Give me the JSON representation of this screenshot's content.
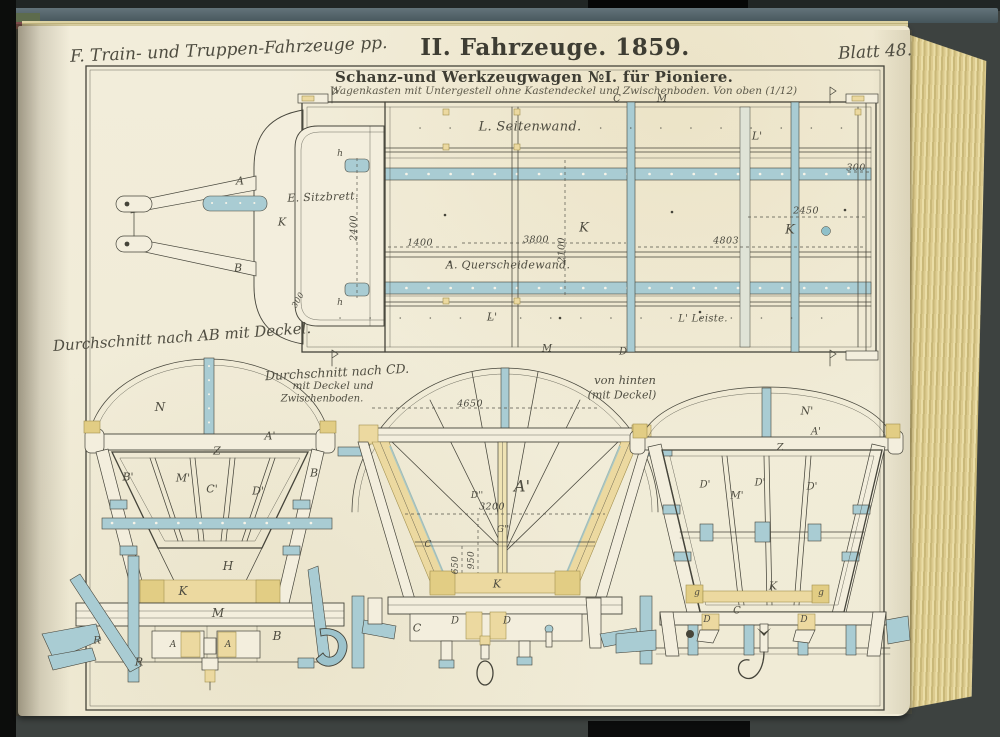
{
  "book": {
    "header_left": "F. Train- und Truppen-Fahrzeuge pp.",
    "header_center": "II. Fahrzeuge. 1859.",
    "header_right": "Blatt 48."
  },
  "plate": {
    "title": "Schanz-und Werkzeugwagen №I. für Pioniere.",
    "subtitle": "Wagenkasten mit Untergestell ohne Kastendeckel und Zwischenboden. Von oben (1/12)",
    "section_ab_caption": "Durchschnitt nach AB mit Deckel.",
    "section_cd_caption_line1": "Durchschnitt nach CD.",
    "section_cd_caption_line2": "mit Deckel und",
    "section_cd_caption_line3": "Zwischenboden.",
    "rear_caption_line1": "von hinten",
    "rear_caption_line2": "(mit Deckel)"
  },
  "colors": {
    "ink": "#45443a",
    "wash_blue": "#a9ccd3",
    "wash_yellow": "#ecd9a0",
    "paper": "#f2edda",
    "cover_edge": "#55656c"
  },
  "annotations": [
    {
      "t": "L. Seitenwand.",
      "x": 530,
      "y": 127,
      "c": "script",
      "fs": 13,
      "n": "label-seitenwand"
    },
    {
      "t": "E. Sitzbrett.",
      "x": 323,
      "y": 197,
      "c": "script",
      "fs": 11,
      "r": -2,
      "n": "label-sitzbrett"
    },
    {
      "t": "A. Querscheidewand.",
      "x": 508,
      "y": 265,
      "c": "script",
      "fs": 11,
      "n": "label-querscheidewand"
    },
    {
      "t": "L' Leiste.",
      "x": 703,
      "y": 319,
      "c": "script",
      "fs": 10,
      "n": "label-leiste"
    },
    {
      "t": "L'",
      "x": 492,
      "y": 317,
      "c": "letter"
    },
    {
      "t": "L'",
      "x": 757,
      "y": 136,
      "c": "letter"
    },
    {
      "t": "K",
      "x": 584,
      "y": 228,
      "c": "letter",
      "fs": 13
    },
    {
      "t": "K",
      "x": 790,
      "y": 230,
      "c": "letter",
      "fs": 13
    },
    {
      "t": "K",
      "x": 282,
      "y": 222,
      "c": "letter"
    },
    {
      "t": "A",
      "x": 240,
      "y": 181,
      "c": "letter"
    },
    {
      "t": "B",
      "x": 238,
      "y": 268,
      "c": "letter"
    },
    {
      "t": "C",
      "x": 617,
      "y": 99,
      "c": "letter",
      "fs": 10
    },
    {
      "t": "M",
      "x": 662,
      "y": 99,
      "c": "letter",
      "fs": 10
    },
    {
      "t": "M",
      "x": 547,
      "y": 349,
      "c": "letter",
      "fs": 10
    },
    {
      "t": "D",
      "x": 623,
      "y": 352,
      "c": "letter",
      "fs": 10
    },
    {
      "t": "h",
      "x": 340,
      "y": 154,
      "c": "letter",
      "fs": 9
    },
    {
      "t": "h",
      "x": 340,
      "y": 303,
      "c": "letter",
      "fs": 9
    },
    {
      "t": "2400",
      "x": 354,
      "y": 228,
      "c": "dim",
      "r": -90
    },
    {
      "t": "1400",
      "x": 420,
      "y": 243,
      "c": "dim"
    },
    {
      "t": "3800",
      "x": 536,
      "y": 240,
      "c": "dim"
    },
    {
      "t": "2100",
      "x": 562,
      "y": 250,
      "c": "dim",
      "r": -90
    },
    {
      "t": "4803",
      "x": 726,
      "y": 241,
      "c": "dim"
    },
    {
      "t": "2450",
      "x": 806,
      "y": 211,
      "c": "dim"
    },
    {
      "t": "300",
      "x": 856,
      "y": 168,
      "c": "dim"
    },
    {
      "t": "300",
      "x": 298,
      "y": 300,
      "c": "dim",
      "r": -60,
      "fs": 8
    },
    {
      "t": "N",
      "x": 160,
      "y": 407,
      "c": "letter",
      "fs": 12
    },
    {
      "t": "A'",
      "x": 270,
      "y": 436,
      "c": "letter"
    },
    {
      "t": "Z",
      "x": 217,
      "y": 451,
      "c": "letter"
    },
    {
      "t": "B'",
      "x": 128,
      "y": 477,
      "c": "letter"
    },
    {
      "t": "M'",
      "x": 183,
      "y": 478,
      "c": "letter"
    },
    {
      "t": "C'",
      "x": 212,
      "y": 489,
      "c": "letter"
    },
    {
      "t": "D'",
      "x": 258,
      "y": 491,
      "c": "letter"
    },
    {
      "t": "B",
      "x": 314,
      "y": 473,
      "c": "letter"
    },
    {
      "t": "H",
      "x": 228,
      "y": 566,
      "c": "letter",
      "fs": 12
    },
    {
      "t": "K",
      "x": 183,
      "y": 591,
      "c": "letter",
      "fs": 12
    },
    {
      "t": "M",
      "x": 218,
      "y": 613,
      "c": "letter",
      "fs": 12
    },
    {
      "t": "B",
      "x": 277,
      "y": 636,
      "c": "letter",
      "fs": 12
    },
    {
      "t": "A",
      "x": 173,
      "y": 645,
      "c": "letter",
      "fs": 9
    },
    {
      "t": "A",
      "x": 228,
      "y": 645,
      "c": "letter",
      "fs": 9
    },
    {
      "t": "R",
      "x": 139,
      "y": 662,
      "c": "letter"
    },
    {
      "t": "R",
      "x": 97,
      "y": 641,
      "c": "letter",
      "fs": 10
    },
    {
      "t": "4650",
      "x": 470,
      "y": 404,
      "c": "dim"
    },
    {
      "t": "A'",
      "x": 522,
      "y": 486,
      "c": "letter",
      "fs": 16
    },
    {
      "t": "D''",
      "x": 477,
      "y": 496,
      "c": "letter",
      "fs": 9
    },
    {
      "t": "3200",
      "x": 492,
      "y": 507,
      "c": "dim"
    },
    {
      "t": "G''",
      "x": 503,
      "y": 530,
      "c": "letter",
      "fs": 9
    },
    {
      "t": "C",
      "x": 428,
      "y": 545,
      "c": "letter",
      "fs": 9
    },
    {
      "t": "650",
      "x": 456,
      "y": 565,
      "c": "dim",
      "r": -90,
      "fs": 9
    },
    {
      "t": "950",
      "x": 472,
      "y": 560,
      "c": "dim",
      "r": -90,
      "fs": 9
    },
    {
      "t": "K",
      "x": 497,
      "y": 584,
      "c": "letter"
    },
    {
      "t": "C",
      "x": 417,
      "y": 628,
      "c": "letter"
    },
    {
      "t": "D",
      "x": 455,
      "y": 621,
      "c": "letter",
      "fs": 10
    },
    {
      "t": "D",
      "x": 507,
      "y": 621,
      "c": "letter",
      "fs": 10
    },
    {
      "t": "N'",
      "x": 807,
      "y": 411,
      "c": "letter"
    },
    {
      "t": "A'",
      "x": 816,
      "y": 432,
      "c": "letter",
      "fs": 10
    },
    {
      "t": "Z",
      "x": 780,
      "y": 448,
      "c": "letter",
      "fs": 10
    },
    {
      "t": "D'",
      "x": 705,
      "y": 485,
      "c": "letter",
      "fs": 10
    },
    {
      "t": "M'",
      "x": 737,
      "y": 496,
      "c": "letter",
      "fs": 10
    },
    {
      "t": "D'",
      "x": 760,
      "y": 483,
      "c": "letter",
      "fs": 10
    },
    {
      "t": "D'",
      "x": 812,
      "y": 487,
      "c": "letter",
      "fs": 10
    },
    {
      "t": "K",
      "x": 773,
      "y": 586,
      "c": "letter"
    },
    {
      "t": "g",
      "x": 697,
      "y": 593,
      "c": "letter",
      "fs": 9
    },
    {
      "t": "g",
      "x": 821,
      "y": 593,
      "c": "letter",
      "fs": 9
    },
    {
      "t": "C",
      "x": 737,
      "y": 611,
      "c": "letter",
      "fs": 10
    },
    {
      "t": "D",
      "x": 707,
      "y": 620,
      "c": "letter",
      "fs": 9
    },
    {
      "t": "D",
      "x": 804,
      "y": 620,
      "c": "letter",
      "fs": 9
    }
  ]
}
